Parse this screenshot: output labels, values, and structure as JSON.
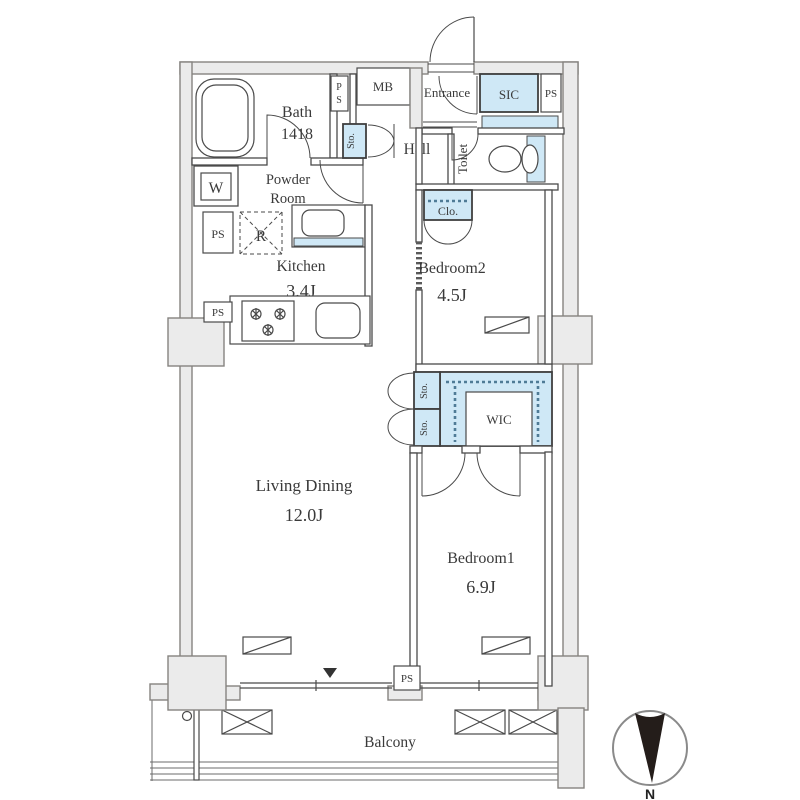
{
  "plan": {
    "title": "2LDK apartment floor plan",
    "labels": {
      "bath": "Bath",
      "bath_size": "1418",
      "powder1": "Powder",
      "powder2": "Room",
      "kitchen": "Kitchen",
      "kitchen_area": "3.4J",
      "hall": "Hall",
      "entrance": "Entrance",
      "mb": "MB",
      "sic": "SIC",
      "toilet": "Toilet",
      "clo": "Clo.",
      "sto": "Sto.",
      "bedroom2": "Bedroom2",
      "bedroom2_area": "4.5J",
      "wic": "WIC",
      "living_dining": "Living Dining",
      "living_dining_area": "12.0J",
      "bedroom1": "Bedroom1",
      "bedroom1_area": "6.9J",
      "balcony": "Balcony",
      "ps": "PS",
      "p": "P",
      "s": "S",
      "w": "W",
      "r": "R",
      "north": "N"
    },
    "colors": {
      "closet_fill": "#cfe8f6",
      "wall_fill": "#ebebeb",
      "line": "#4a4a4a",
      "compass_needle": "#241d1a"
    }
  }
}
